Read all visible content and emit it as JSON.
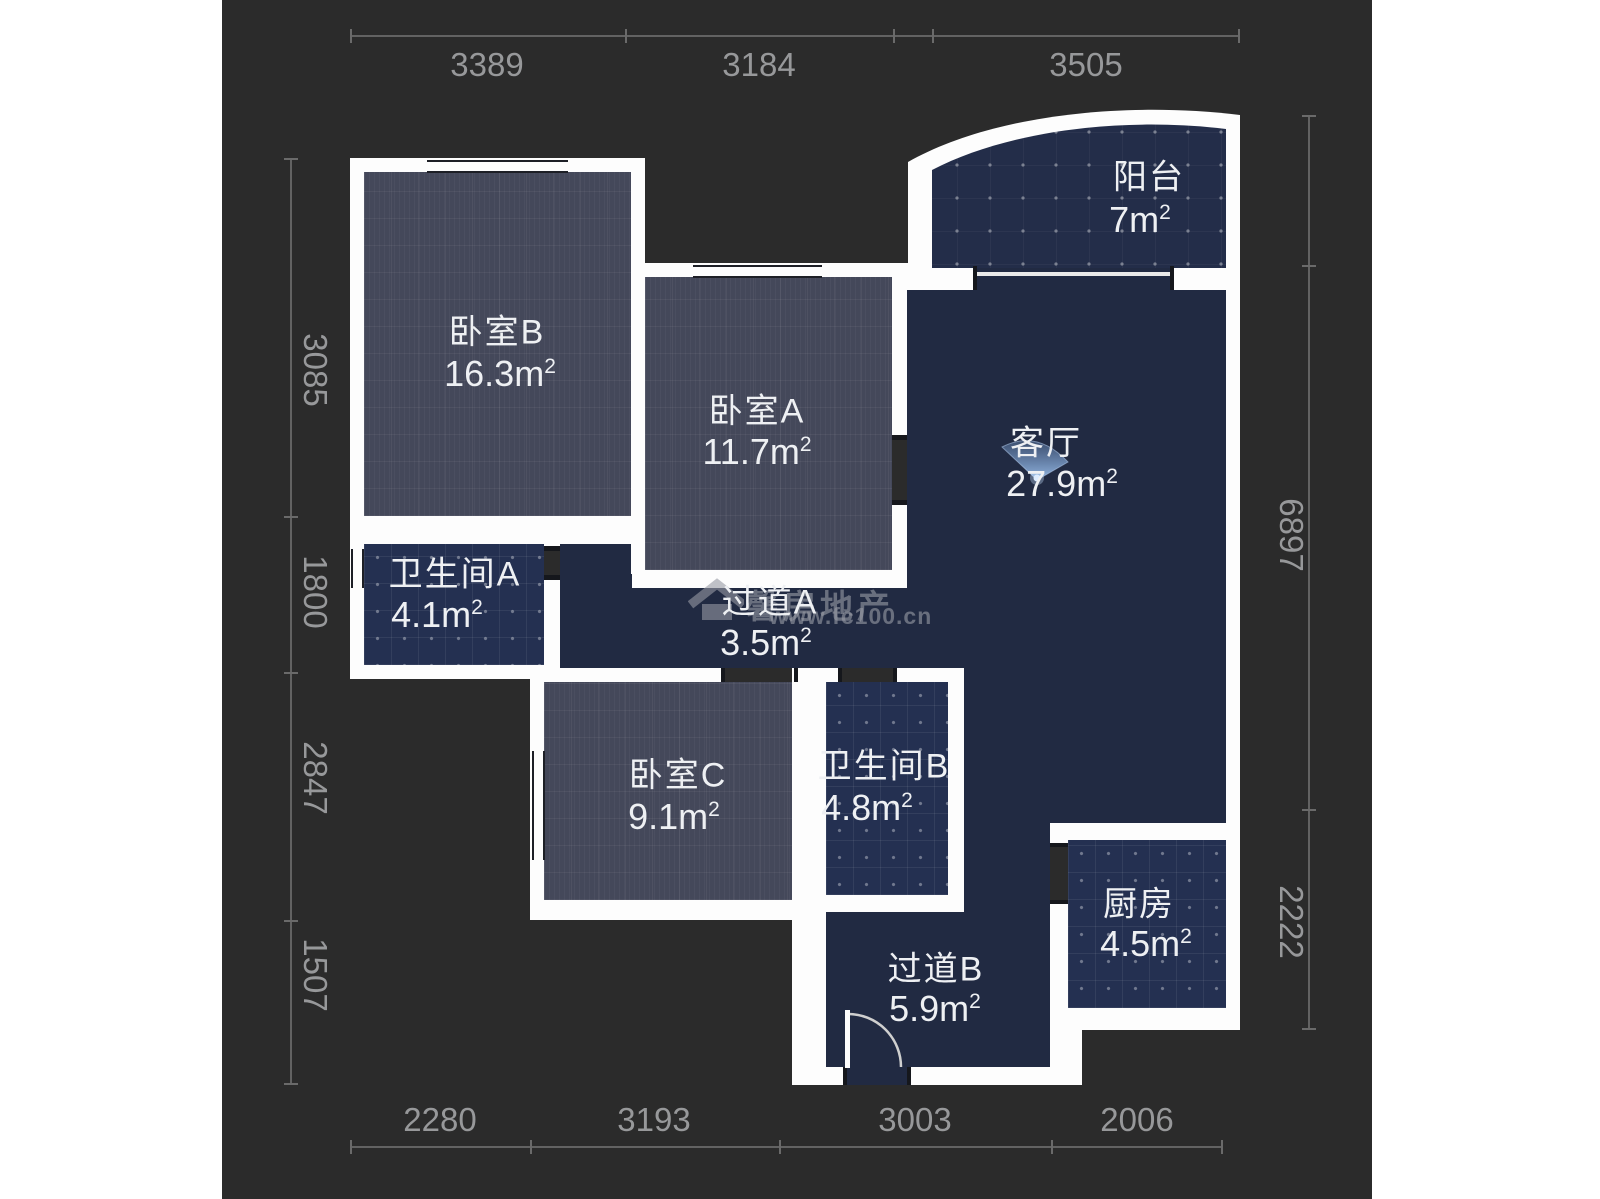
{
  "meta": {
    "sup": "2"
  },
  "rooms": [
    {
      "name": "卧室B",
      "area": "16.3m"
    },
    {
      "name": "卧室A",
      "area": "11.7m"
    },
    {
      "name": "阳台",
      "area": "7m"
    },
    {
      "name": "客厅",
      "area": "27.9m"
    },
    {
      "name": "卫生间A",
      "area": "4.1m"
    },
    {
      "name": "过道A",
      "area": "3.5m"
    },
    {
      "name": "卧室C",
      "area": "9.1m"
    },
    {
      "name": "卫生间B",
      "area": "4.8m"
    },
    {
      "name": "厨房",
      "area": "4.5m"
    },
    {
      "name": "过道B",
      "area": "5.9m"
    }
  ],
  "dimensions": {
    "top": [
      "3389",
      "3184",
      "3505"
    ],
    "bottom": [
      "2280",
      "3193",
      "3003",
      "2006"
    ],
    "left": [
      "3085",
      "1800",
      "2847",
      "1507"
    ],
    "right": [
      "6897",
      "2222"
    ]
  },
  "watermark": {
    "brand": "馨房地产",
    "url": "www.fc100.cn"
  },
  "colors": {
    "wall": "#fdfdfd",
    "plan_bg": "#2b2b2b",
    "bedroom_fill": "#44485a",
    "wet_room_fill": "#243051",
    "open_space_fill": "#212a42",
    "viewpoint_blue": "#8fc0f2"
  }
}
